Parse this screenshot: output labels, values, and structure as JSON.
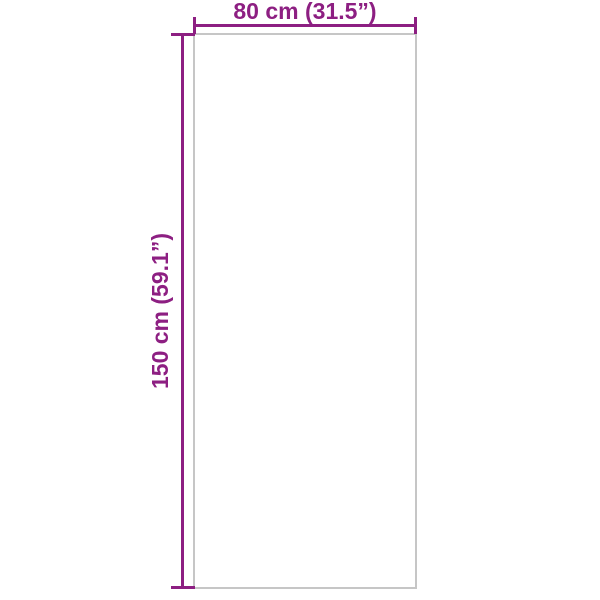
{
  "diagram": {
    "title": "product-dimension-diagram",
    "width_label": "80 cm (31.5”)",
    "height_label": "150 cm (59.1”)",
    "colors": {
      "dimension": "#8D1F82",
      "outline": "#C6C6C6",
      "background": "#FFFFFF"
    }
  }
}
